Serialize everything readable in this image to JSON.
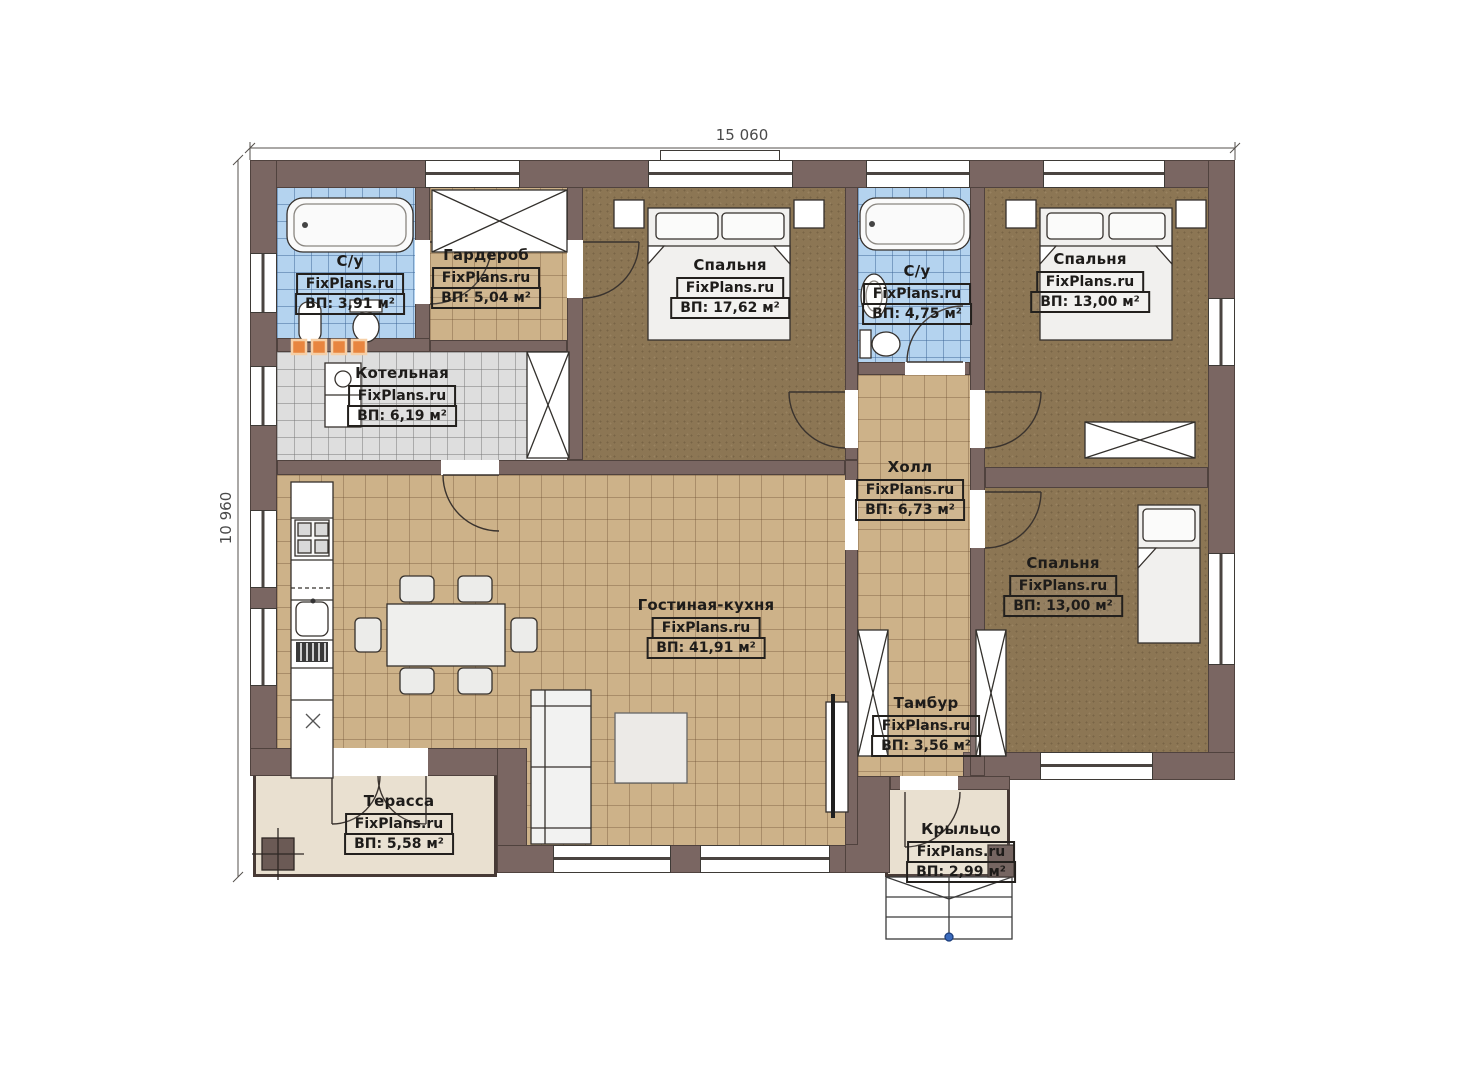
{
  "watermark": "FixPlans.ru",
  "dimensions": {
    "width_label": "15 060",
    "height_label": "10 960"
  },
  "rooms": [
    {
      "name": "С/у",
      "area": "ВП: 3,91 м²"
    },
    {
      "name": "Гардероб",
      "area": "ВП: 5,04 м²"
    },
    {
      "name": "Спальня",
      "area": "ВП: 17,62 м²"
    },
    {
      "name": "С/у",
      "area": "ВП: 4,75 м²"
    },
    {
      "name": "Спальня",
      "area": "ВП: 13,00 м²"
    },
    {
      "name": "Котельная",
      "area": "ВП: 6,19 м²"
    },
    {
      "name": "Холл",
      "area": "ВП: 6,73 м²"
    },
    {
      "name": "Гостиная-кухня",
      "area": "ВП: 41,91 м²"
    },
    {
      "name": "Спальня",
      "area": "ВП: 13,00 м²"
    },
    {
      "name": "Тамбур",
      "area": "ВП: 3,56 м²"
    },
    {
      "name": "Терасса",
      "area": "ВП: 5,58 м²"
    },
    {
      "name": "Крыльцо",
      "area": "ВП: 2,99 м²"
    }
  ],
  "colors": {
    "wall": "#7a6662",
    "tile_floor": "#cdb289",
    "bathroom_tile": "#b4d3ef",
    "boiler_tile": "#dedede",
    "bedroom_carpet": "#8c7654",
    "outdoor": "#e9e0d0",
    "radiator_accent": "#e8853f",
    "entry_dot": "#3a6abc"
  }
}
